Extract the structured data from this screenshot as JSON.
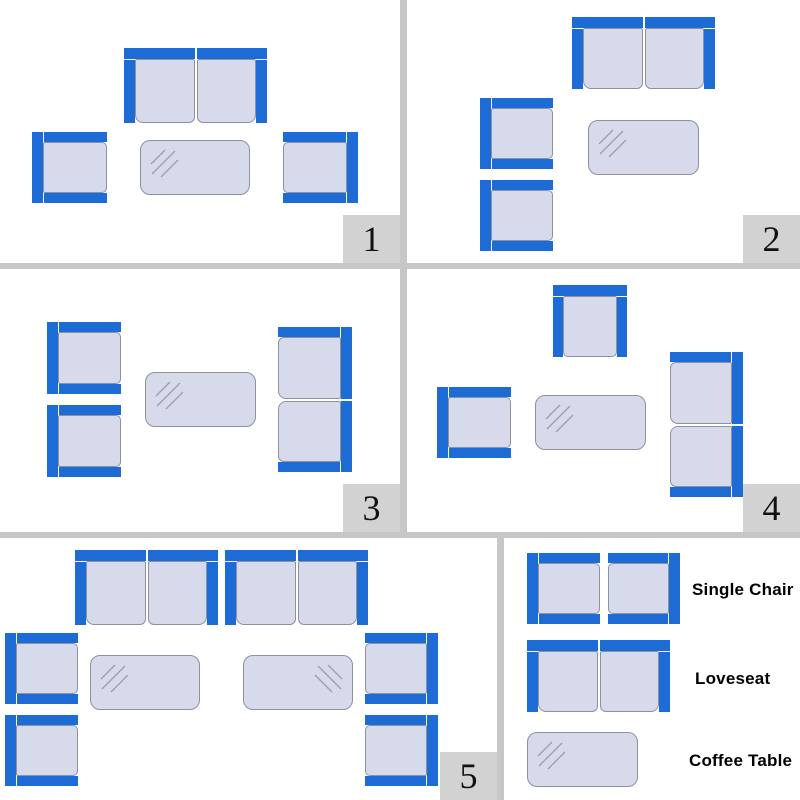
{
  "colors": {
    "frame_blue": "#1d6bd5",
    "cushion_fill": "#d7daeb",
    "cushion_border": "#8b91a1",
    "divider_gray": "#c7c7c7",
    "badge_gray": "#d2d2d2",
    "panel_background": "#ffffff",
    "glare_gray": "#9aa0b0",
    "number_color": "#111111",
    "label_color": "#000000"
  },
  "panels": [
    {
      "name": "layout-1",
      "number": "1",
      "items": [
        {
          "type": "loveseat",
          "facing": "down",
          "x": 124,
          "y": 48,
          "w": 143,
          "h": 75
        },
        {
          "type": "single-chair",
          "facing": "right",
          "x": 32,
          "y": 132,
          "w": 75,
          "h": 71
        },
        {
          "type": "single-chair",
          "facing": "left",
          "x": 283,
          "y": 132,
          "w": 75,
          "h": 71
        },
        {
          "type": "coffee-table",
          "glare": "tl",
          "x": 140,
          "y": 140,
          "w": 110,
          "h": 55
        }
      ]
    },
    {
      "name": "layout-2",
      "number": "2",
      "items": [
        {
          "type": "loveseat",
          "facing": "down",
          "x": 165,
          "y": 17,
          "w": 143,
          "h": 72
        },
        {
          "type": "single-chair",
          "facing": "right",
          "x": 73,
          "y": 98,
          "w": 73,
          "h": 71
        },
        {
          "type": "single-chair",
          "facing": "right",
          "x": 73,
          "y": 180,
          "w": 73,
          "h": 71
        },
        {
          "type": "coffee-table",
          "glare": "tl",
          "x": 181,
          "y": 120,
          "w": 111,
          "h": 55
        }
      ]
    },
    {
      "name": "layout-3",
      "number": "3",
      "items": [
        {
          "type": "single-chair",
          "facing": "right",
          "x": 47,
          "y": 53,
          "w": 74,
          "h": 72
        },
        {
          "type": "single-chair",
          "facing": "right",
          "x": 47,
          "y": 136,
          "w": 74,
          "h": 72
        },
        {
          "type": "coffee-table",
          "glare": "tl",
          "x": 145,
          "y": 103,
          "w": 111,
          "h": 55
        },
        {
          "type": "loveseat",
          "facing": "left",
          "x": 278,
          "y": 58,
          "w": 74,
          "h": 145
        }
      ]
    },
    {
      "name": "layout-4",
      "number": "4",
      "items": [
        {
          "type": "single-chair",
          "facing": "down",
          "x": 146,
          "y": 16,
          "w": 74,
          "h": 72
        },
        {
          "type": "single-chair",
          "facing": "right",
          "x": 30,
          "y": 118,
          "w": 74,
          "h": 71
        },
        {
          "type": "coffee-table",
          "glare": "tl",
          "x": 128,
          "y": 126,
          "w": 111,
          "h": 55
        },
        {
          "type": "loveseat",
          "facing": "left",
          "x": 263,
          "y": 83,
          "w": 73,
          "h": 145
        }
      ]
    },
    {
      "name": "layout-5",
      "number": "5",
      "items": [
        {
          "type": "loveseat",
          "facing": "down",
          "x": 75,
          "y": 12,
          "w": 143,
          "h": 75
        },
        {
          "type": "loveseat",
          "facing": "down",
          "x": 225,
          "y": 12,
          "w": 143,
          "h": 75
        },
        {
          "type": "single-chair",
          "facing": "right",
          "x": 5,
          "y": 95,
          "w": 73,
          "h": 71
        },
        {
          "type": "single-chair",
          "facing": "right",
          "x": 5,
          "y": 177,
          "w": 73,
          "h": 71
        },
        {
          "type": "single-chair",
          "facing": "left",
          "x": 365,
          "y": 95,
          "w": 73,
          "h": 71
        },
        {
          "type": "single-chair",
          "facing": "left",
          "x": 365,
          "y": 177,
          "w": 73,
          "h": 71
        },
        {
          "type": "coffee-table",
          "glare": "tl",
          "x": 90,
          "y": 117,
          "w": 110,
          "h": 55
        },
        {
          "type": "coffee-table",
          "glare": "tr",
          "x": 243,
          "y": 117,
          "w": 110,
          "h": 55
        }
      ]
    }
  ],
  "legend": {
    "samples": [
      {
        "type": "single-chair",
        "facing": "right",
        "x": 23,
        "y": 15,
        "w": 73,
        "h": 71
      },
      {
        "type": "single-chair",
        "facing": "left",
        "x": 104,
        "y": 15,
        "w": 72,
        "h": 71
      },
      {
        "type": "loveseat",
        "facing": "down",
        "x": 23,
        "y": 102,
        "w": 143,
        "h": 72
      },
      {
        "type": "coffee-table",
        "glare": "tl",
        "x": 23,
        "y": 194,
        "w": 111,
        "h": 55
      }
    ],
    "labels": [
      {
        "text": "Single Chair"
      },
      {
        "text": "Loveseat"
      },
      {
        "text": "Coffee Table"
      }
    ]
  }
}
